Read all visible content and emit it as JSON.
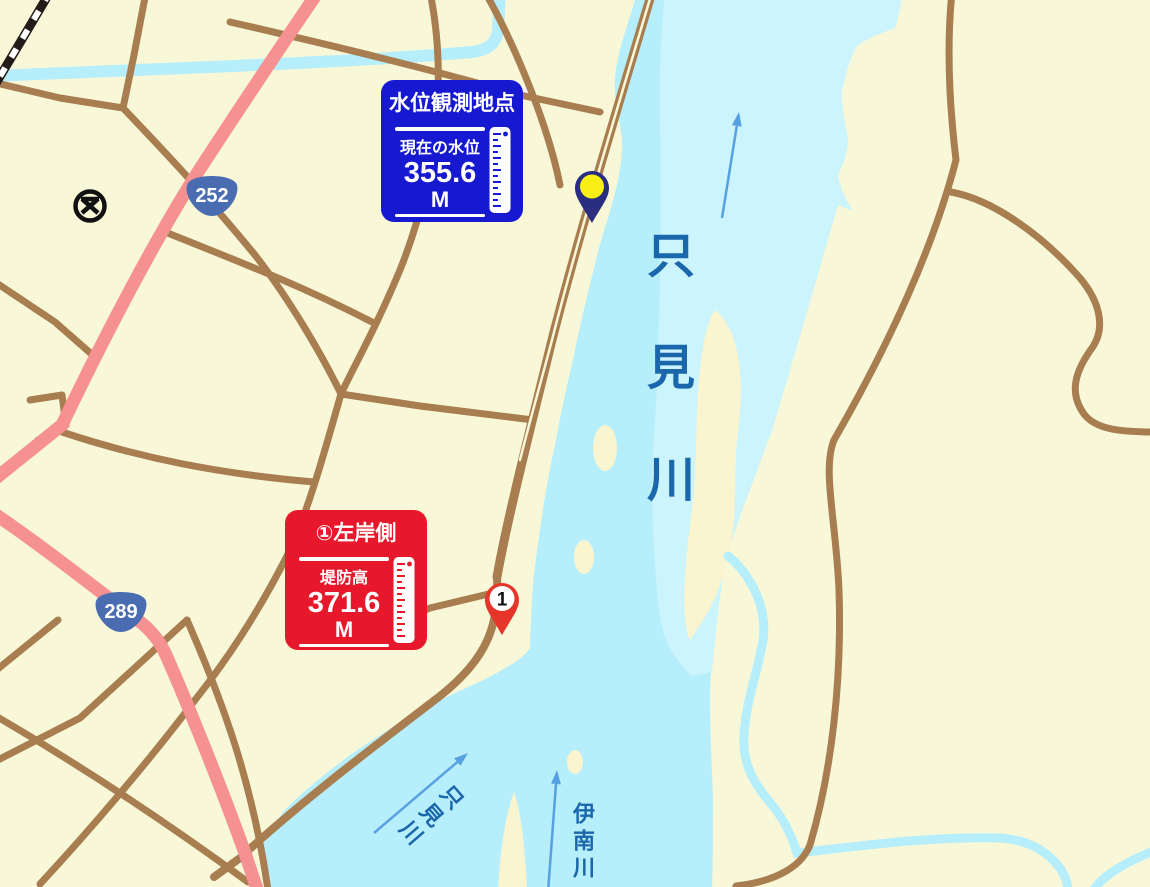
{
  "map": {
    "water_level_station": {
      "title": "水位観測地点",
      "label": "現在の水位",
      "value": "355.6",
      "unit": "M"
    },
    "levee_point": {
      "title": "①左岸側",
      "label": "堤防高",
      "value": "371.6",
      "unit": "M",
      "marker_number": "1"
    },
    "route_badges": {
      "route_252": "252",
      "route_289": "289"
    },
    "river_labels": {
      "tadami_main": "只見川",
      "tadami_branch": "只見川",
      "ina_branch": "伊南川"
    },
    "colors": {
      "water": "#b7eefb",
      "water_light": "#ccf4fd",
      "land": "#f8f8d8",
      "sandbar": "#faf4cf",
      "road": "#a87d50",
      "route_road": "#f69191",
      "info_blue": "#1619cf",
      "info_red": "#e7182b",
      "river_label": "#1a67ab",
      "arrow": "#57a0e1",
      "badge": "#4a6db2",
      "pin_navy": "#2b2d80",
      "pin_yellow": "#f8ef16",
      "pin_red": "#e6362b",
      "railway": "#231a1a"
    }
  }
}
